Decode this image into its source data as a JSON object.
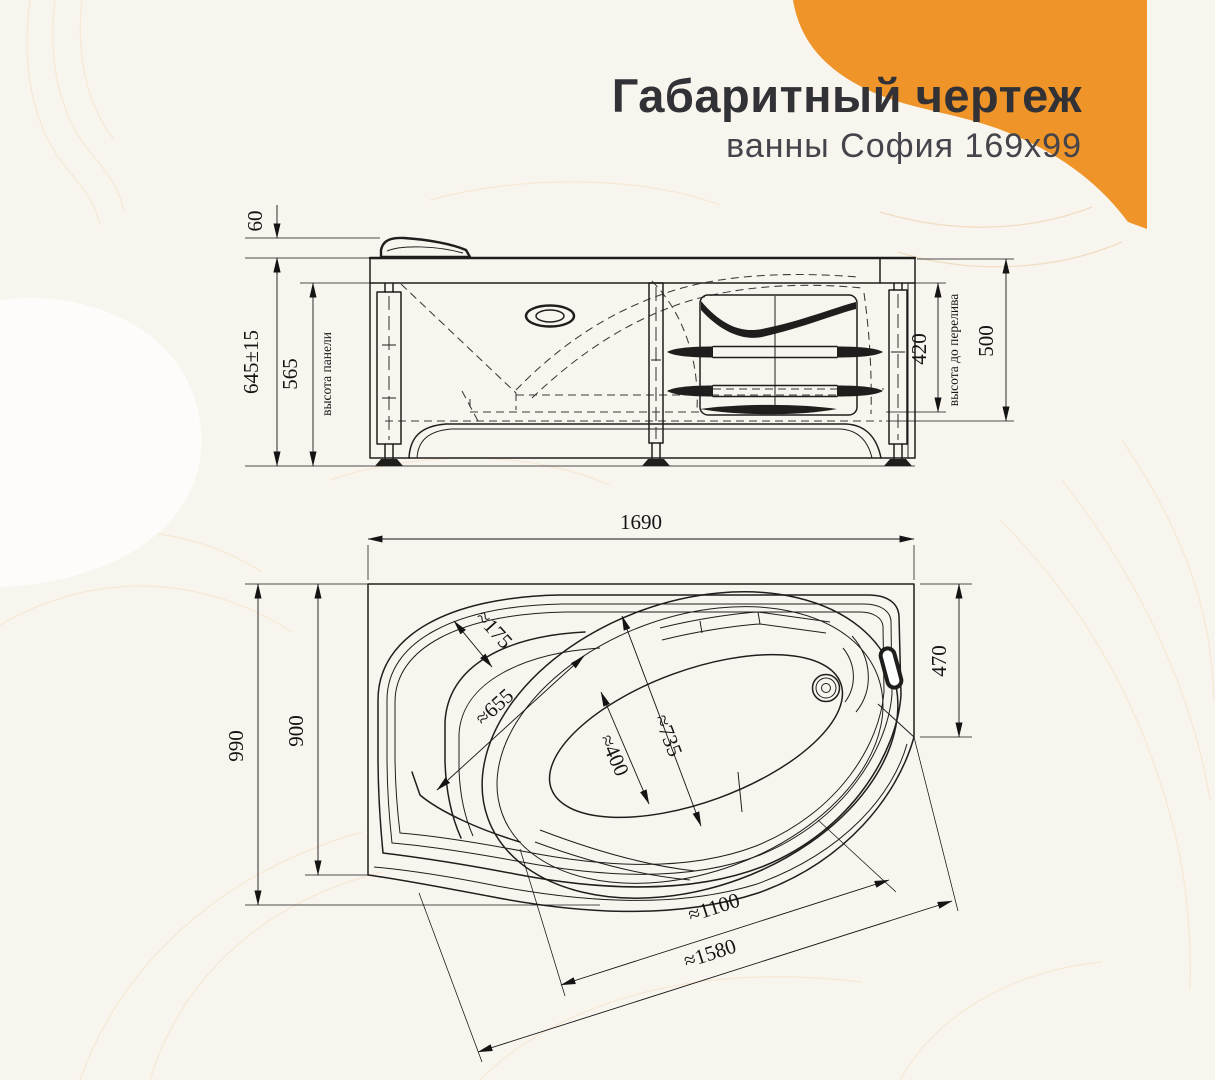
{
  "header": {
    "title": "Габаритный чертеж",
    "subtitle": "ванны София 169x99"
  },
  "side_view": {
    "top_offset": "60",
    "total_height": "645±15",
    "panel_height": "565",
    "panel_height_label": "высота панели",
    "overflow_height": "420",
    "overflow_height_label": "высота до перелива",
    "rim_height": "500"
  },
  "plan_view": {
    "length": "1690",
    "width_total": "990",
    "width_inner": "900",
    "end_width": "470",
    "shelf_width": "≈175",
    "seat_length": "≈655",
    "bowl_width": "≈735",
    "floor_width": "≈400",
    "diagonal_inner": "≈1100",
    "diagonal_outer": "≈1580"
  },
  "colors": {
    "accent": "#ef9428",
    "background": "#f8f5ef",
    "ink": "#1f1e1c",
    "contour": "#f1ddc2"
  }
}
